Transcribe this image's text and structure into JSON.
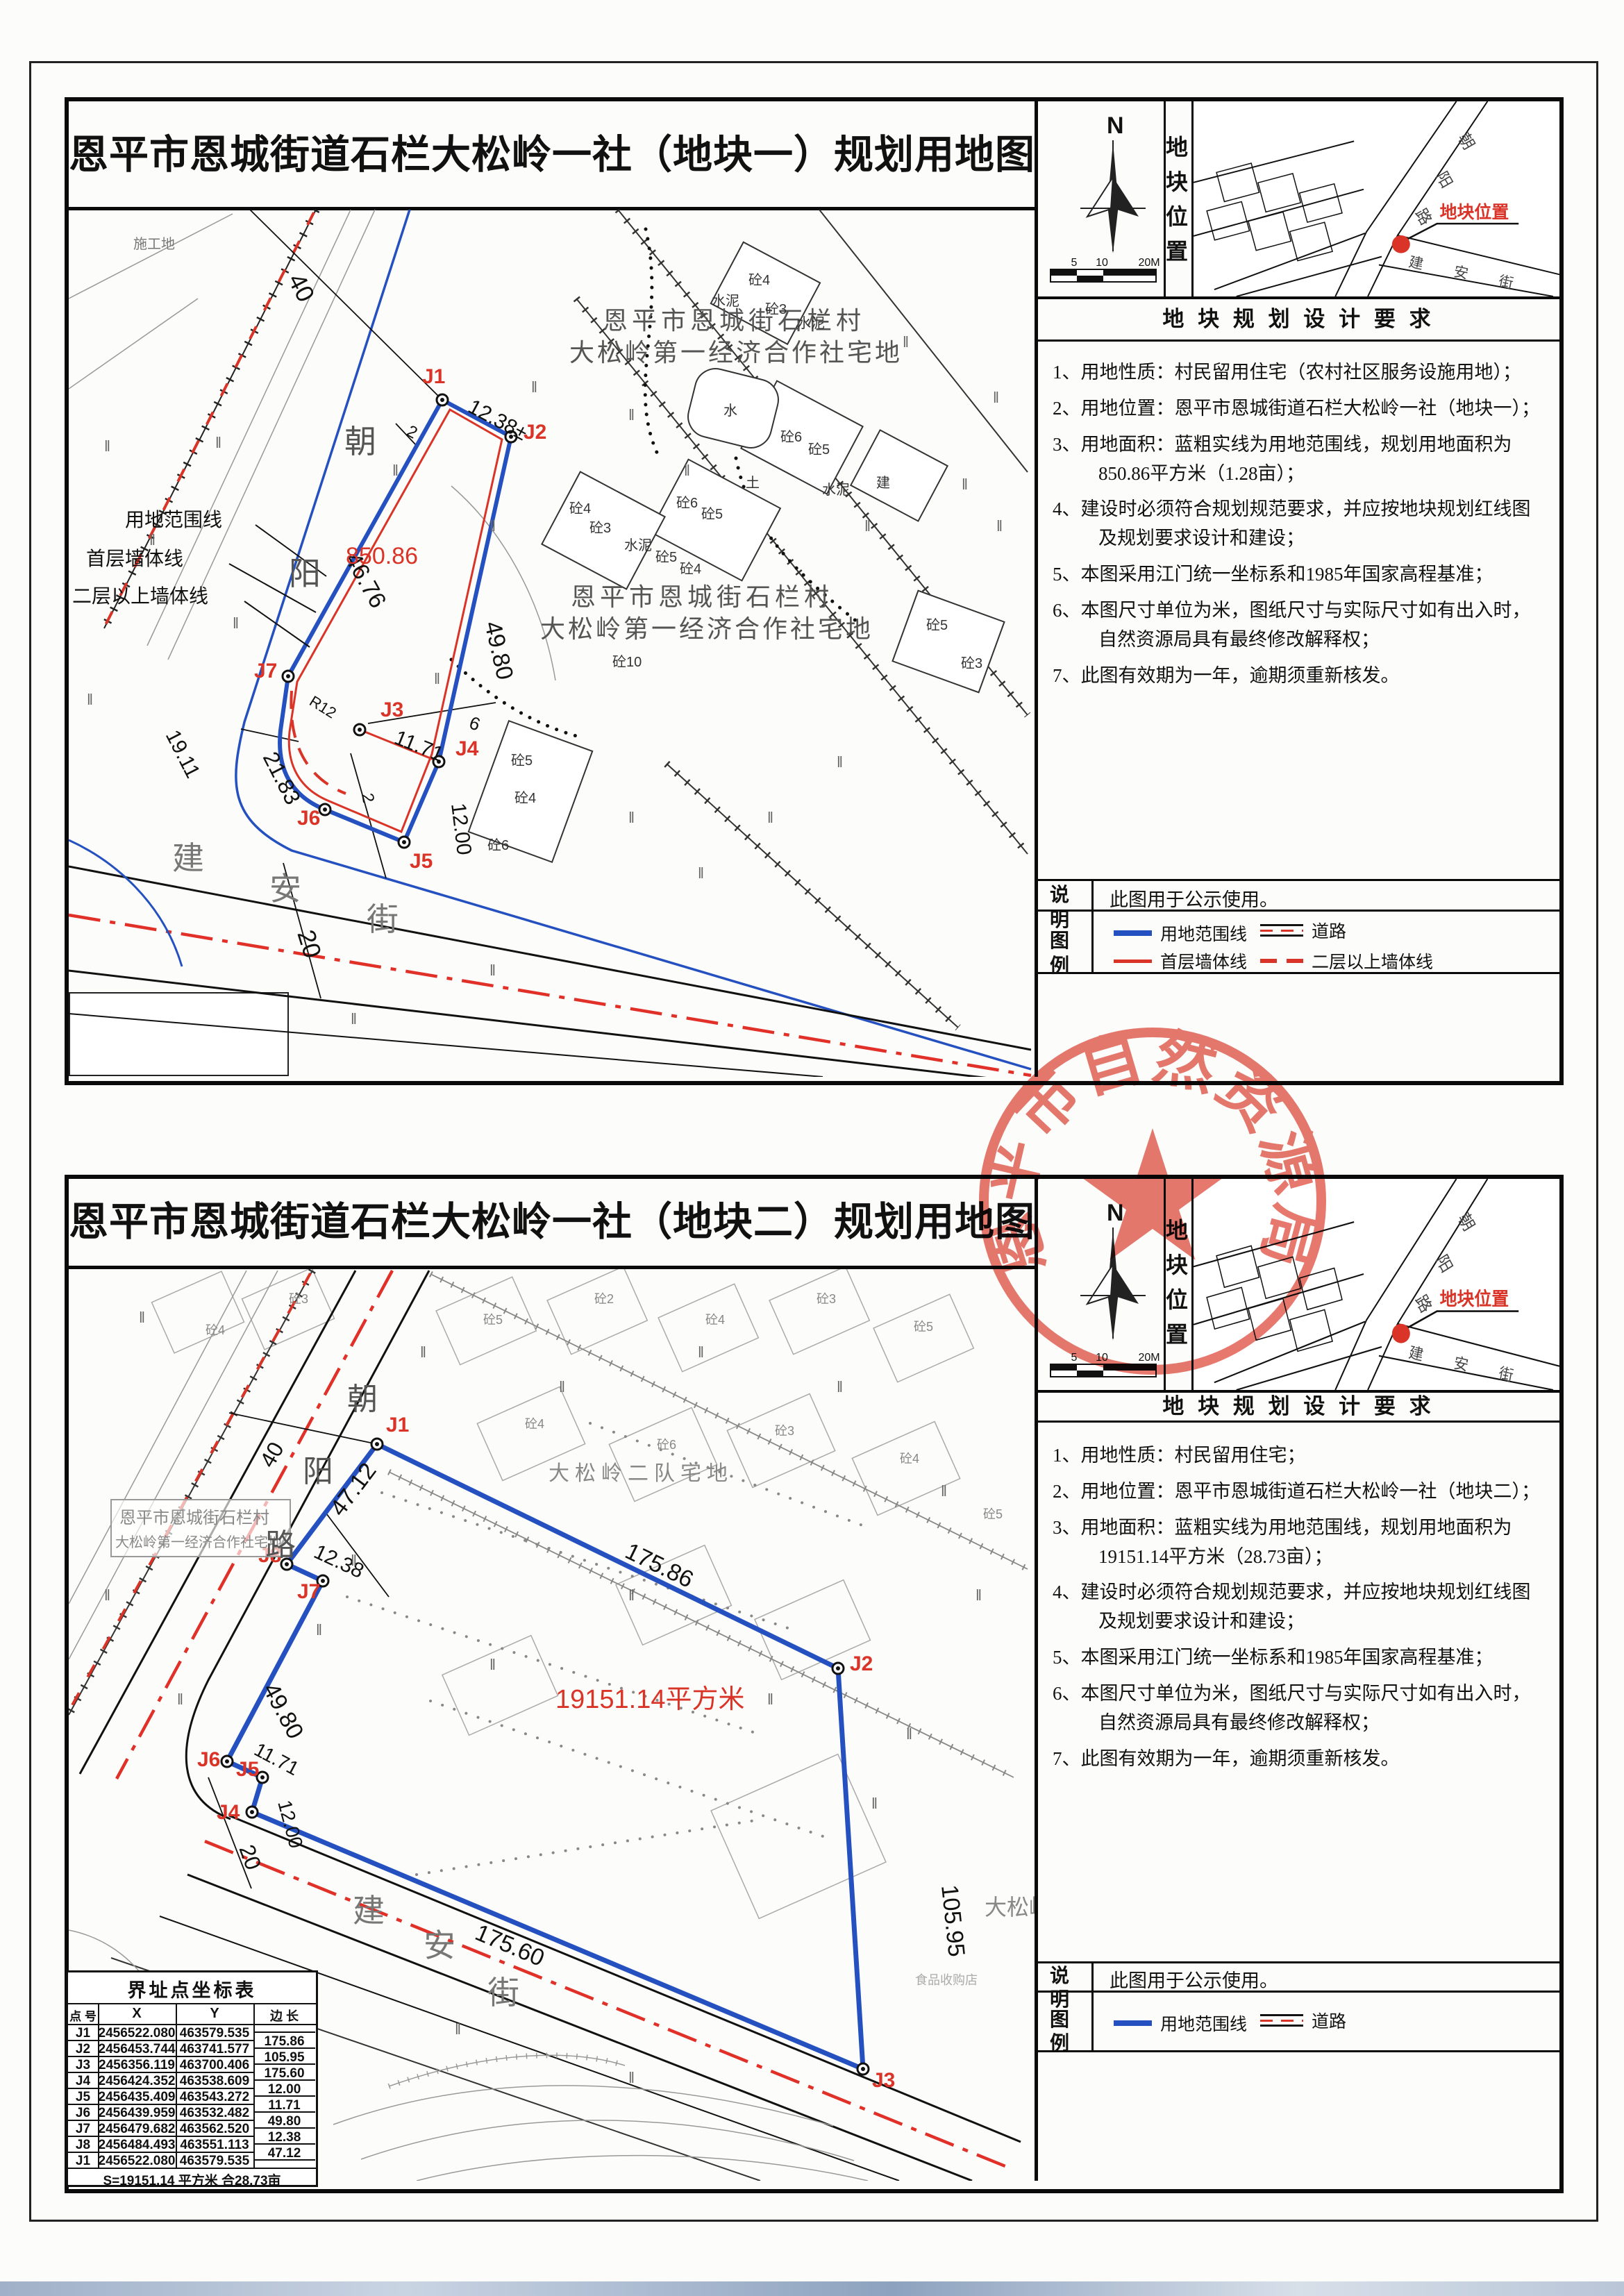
{
  "shared": {
    "compass_n": "N",
    "scale_ticks": [
      "5",
      "10",
      "20M"
    ],
    "strip_label": "地块位置",
    "req_header": "地 块 规 划 设 计 要 求",
    "notes_label": "说  明",
    "legend_label": "图  例",
    "notes_text": "此图用于公示使用。",
    "inset": {
      "marker_label": "地块位置",
      "diag_street": [
        "朝",
        "阳",
        "路"
      ],
      "cross_street": [
        "建",
        "安",
        "街"
      ]
    },
    "legend_items": {
      "boundary": "用地范围线",
      "first_floor": "首层墙体线",
      "road": "道路",
      "upper_wall": "二层以上墙体线"
    }
  },
  "panel1": {
    "title": "恩平市恩城街道石栏大松岭一社（地块一）规划用地图",
    "requirements": [
      "1、用地性质：村民留用住宅（农村社区服务设施用地）；",
      "2、用地位置：恩平市恩城街道石栏大松岭一社（地块一）；",
      "3、用地面积：蓝粗实线为用地范围线，规划用地面积为850.86平方米（1.28亩）；",
      "4、建设时必须符合规划规范要求，并应按地块规划红线图及规划要求设计和建设；",
      "5、本图采用江门统一坐标系和1985年国家高程基准；",
      "6、本图尺寸单位为米，图纸尺寸与实际尺寸如有出入时，自然资源局具有最终修改解释权；",
      "7、此图有效期为一年，逾期须重新核发。"
    ],
    "map": {
      "area": "850.86",
      "points": [
        "J1",
        "J2",
        "J3",
        "J4",
        "J5",
        "J6",
        "J7"
      ],
      "dims": {
        "j1j2": "12.38±",
        "left": "46.76",
        "right": "49.80",
        "j3j4": "11.71",
        "j4j5": "12.00",
        "curve": "21.83",
        "bottom": "19.11",
        "radius": "R12",
        "road40": "40",
        "road20": "20",
        "m2a": "2",
        "m2b": "2",
        "m6": "6"
      },
      "village1": "恩平市恩城街石栏村",
      "village2": "大松岭第一经济合作社宅地",
      "diag_street": [
        "朝",
        "阳"
      ],
      "cross_street": [
        "建",
        "安",
        "街"
      ],
      "callouts": [
        "用地范围线",
        "首层墙体线",
        "二层以上墙体线"
      ],
      "site_label": "施工地",
      "grass": "‖",
      "buildings": [
        "砼2",
        "砼4",
        "水泥",
        "砼3",
        "水泥",
        "水",
        "砼6",
        "砼5",
        "土",
        "水泥",
        "建",
        "砼4",
        "砼3",
        "水泥",
        "砼6",
        "砼5",
        "砼5",
        "砼4",
        "砼10",
        "砼5",
        "砼4",
        "砼6",
        "砼5",
        "砼3"
      ]
    }
  },
  "panel2": {
    "title": "恩平市恩城街道石栏大松岭一社（地块二）规划用地图",
    "requirements": [
      "1、用地性质：村民留用住宅；",
      "2、用地位置：恩平市恩城街道石栏大松岭一社（地块二）；",
      "3、用地面积：蓝粗实线为用地范围线，规划用地面积为19151.14平方米（28.73亩）；",
      "4、建设时必须符合规划规范要求，并应按地块规划红线图及规划要求设计和建设；",
      "5、本图采用江门统一坐标系和1985年国家高程基准；",
      "6、本图尺寸单位为米，图纸尺寸与实际尺寸如有出入时，自然资源局具有最终修改解释权；",
      "7、此图有效期为一年，逾期须重新核发。"
    ],
    "map": {
      "area": "19151.14平方米",
      "points": [
        "J1",
        "J2",
        "J3",
        "J4",
        "J5",
        "J6",
        "J7",
        "J8"
      ],
      "dims": {
        "j1j2": "175.86",
        "j2j3": "105.95",
        "j3j4": "175.60",
        "j4j5": "12.00",
        "j5j6": "11.71",
        "j6j7": "49.80",
        "j7j8": "12.38",
        "j8j1": "47.12",
        "road40": "40",
        "road20": "20"
      },
      "village1": "恩平市恩城街石栏村",
      "village2": "大松岭第一经济合作社宅地",
      "team": "大松岭二队宅地",
      "hill": "大松岭",
      "shop": "食品收购店",
      "diag_street": [
        "朝",
        "阳",
        "路"
      ],
      "cross_street": [
        "建",
        "安",
        "街"
      ],
      "grass": "‖",
      "buildings": [
        "砼4",
        "砼3",
        "砼5",
        "砼2",
        "砼4",
        "砼3",
        "砼5",
        "砼4",
        "砼6",
        "砼3",
        "砼4",
        "砼5"
      ]
    },
    "table": {
      "title": "界址点坐标表",
      "headers": [
        "点 号",
        "X",
        "Y",
        "边 长"
      ],
      "rows": [
        [
          "J1",
          "2456522.080",
          "463579.535"
        ],
        [
          "J2",
          "2456453.744",
          "463741.577"
        ],
        [
          "J3",
          "2456356.119",
          "463700.406"
        ],
        [
          "J4",
          "2456424.352",
          "463538.609"
        ],
        [
          "J5",
          "2456435.409",
          "463543.272"
        ],
        [
          "J6",
          "2456439.959",
          "463532.482"
        ],
        [
          "J7",
          "2456479.682",
          "463562.520"
        ],
        [
          "J8",
          "2456484.493",
          "463551.113"
        ],
        [
          "J1",
          "2456522.080",
          "463579.535"
        ]
      ],
      "lengths": [
        "175.86",
        "105.95",
        "175.60",
        "12.00",
        "11.71",
        "49.80",
        "12.38",
        "47.12"
      ],
      "footer": "S=19151.14 平方米 合28.73亩"
    }
  },
  "seal": {
    "text": "恩平市自然资源局",
    "star": "★"
  }
}
